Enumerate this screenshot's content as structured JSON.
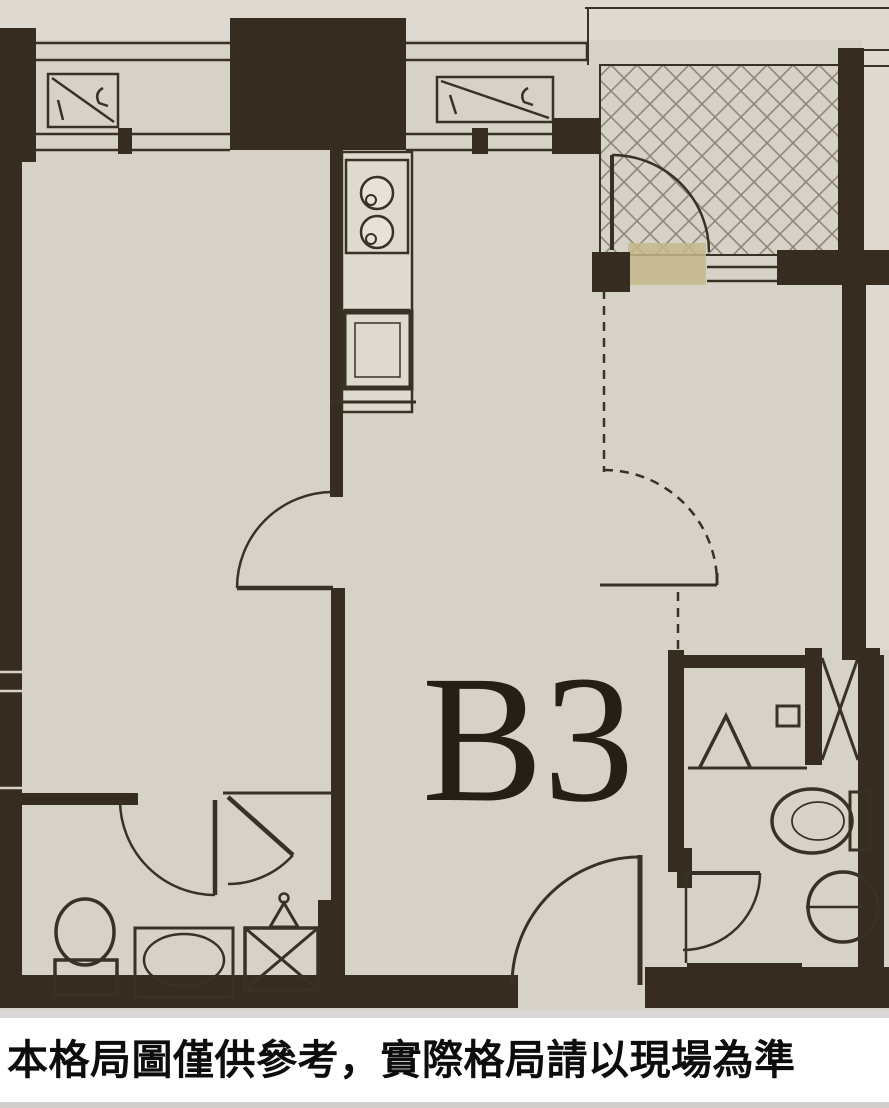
{
  "plan": {
    "unit_label": "B3",
    "disclaimer": "本格局圖僅供參考，實際格局請以現場為準"
  },
  "colors": {
    "floor_background": "#d6d2c8",
    "outside_background": "#dedad1",
    "wall": "#362d20",
    "line": "#3a3126",
    "hatch": "#8f8878",
    "threshold_tan": "#c6b98c",
    "caption_background": "#ffffff",
    "caption_text": "#0d0d0d",
    "unit_label_color": "#261f17"
  },
  "icons": {
    "entry_tile_hatch": "cross-hatched entry floor",
    "ac_unit": "outdoor AC unit on ledge (rectangle with diagonal)",
    "stove": "two-burner stove",
    "sink": "kitchen sink",
    "door_arc": "door swing arc",
    "dashed_opening": "dashed partition/swing",
    "toilet": "toilet",
    "washbasin": "washbasin",
    "shower": "shower symbol",
    "laundry_box": "x-crossed utility box",
    "pipe_shaft": "x-crossed pipe shaft",
    "floor_drain_funnel": "funnel drain symbol"
  }
}
